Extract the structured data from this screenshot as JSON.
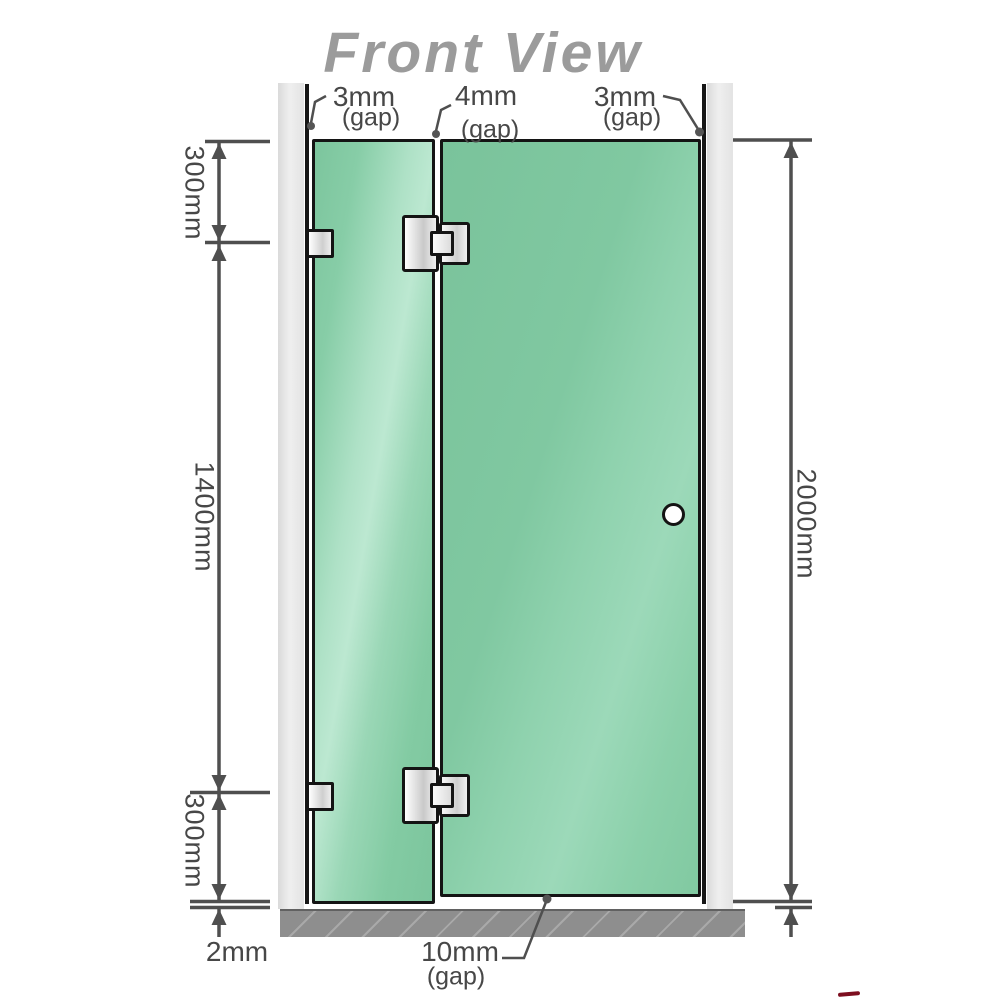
{
  "title": "Front View",
  "gaps": {
    "top_left": {
      "value": "3mm",
      "label": "(gap)"
    },
    "top_middle": {
      "value": "4mm",
      "label": "(gap)"
    },
    "top_right": {
      "value": "3mm",
      "label": "(gap)"
    },
    "bottom": {
      "value": "10mm",
      "label": "(gap)"
    },
    "bottom_left_floor": "2mm"
  },
  "measurements": {
    "left_top": "300mm",
    "left_middle": "1400mm",
    "left_bottom": "300mm",
    "right_total": "2000mm"
  },
  "colors": {
    "glass_green": "#86cda7",
    "glass_highlight": "#b7e6cd",
    "wall_gray": "#e6e6e6",
    "floor_gray": "#8e8e8e",
    "outline_black": "#161616",
    "dimension_gray": "#4f4f4f",
    "title_gray": "#9b9b9b",
    "accent_mark_red": "#7d0e1f"
  }
}
